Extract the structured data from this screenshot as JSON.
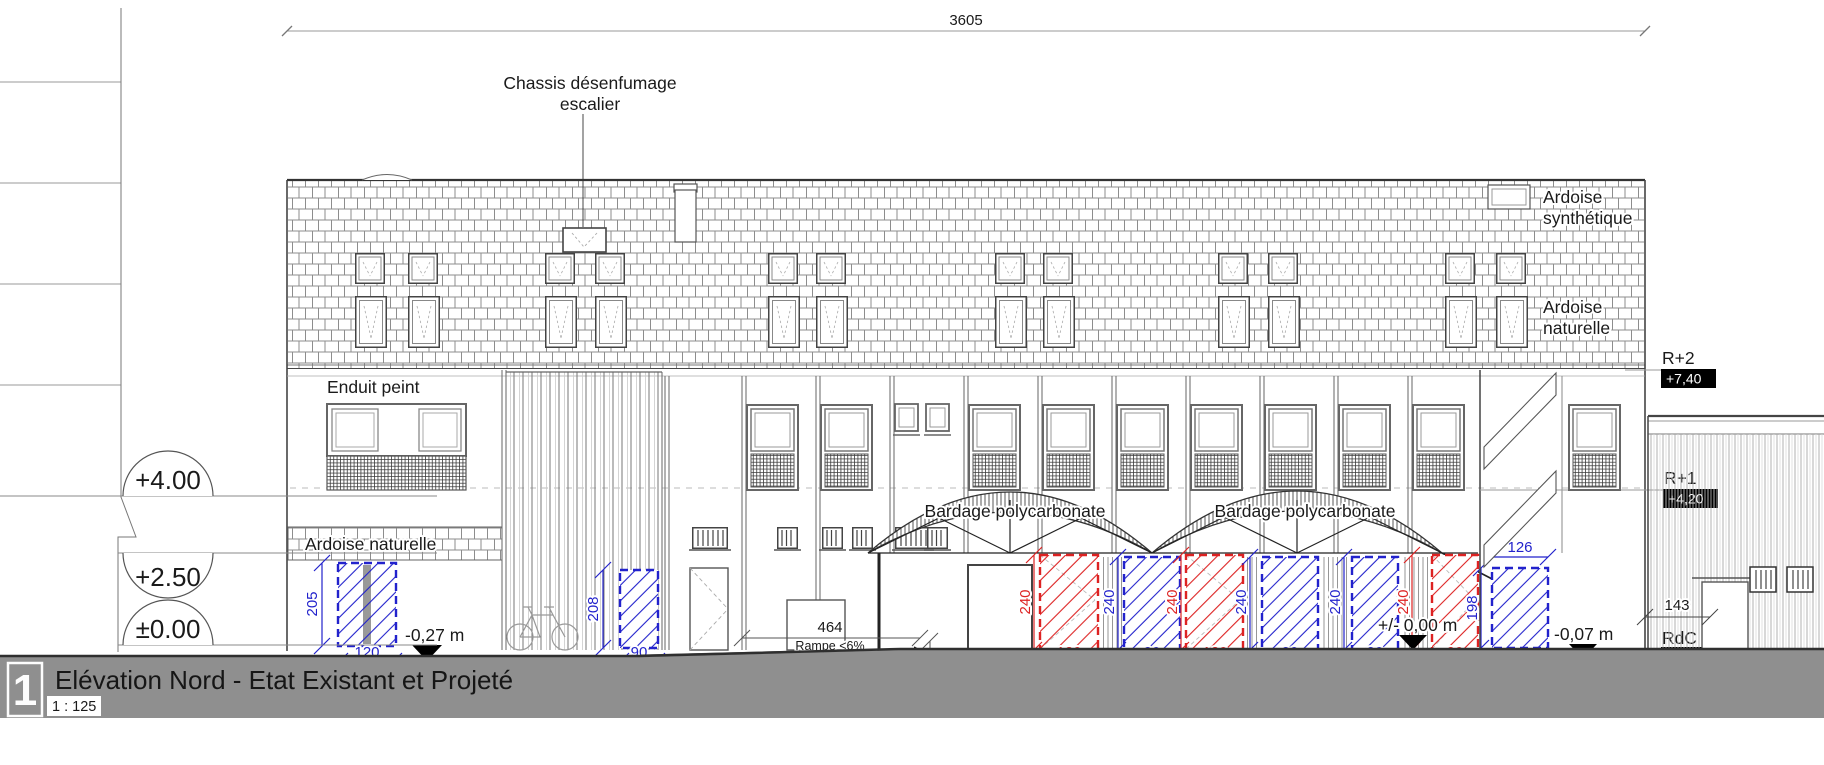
{
  "colors": {
    "projected_red": "#dd2222",
    "existing_blue": "#2222cc",
    "ground_gray": "#8f8f8f"
  },
  "title_block": {
    "sheet_number": "1",
    "title": "Elévation Nord - Etat Existant et Projeté",
    "scale": "1 : 125"
  },
  "top_dimension": "3605",
  "annotation_smoke_vent": {
    "line1": "Chassis désenfumage",
    "line2": "escalier"
  },
  "material_labels": {
    "enduit_peint": "Enduit peint",
    "ardoise_naturelle_left": "Ardoise naturelle",
    "ardoise_synthetique": {
      "line1": "Ardoise",
      "line2": "synthétique"
    },
    "ardoise_naturelle_right": {
      "line1": "Ardoise",
      "line2": "naturelle"
    },
    "bardage_1": "Bardage polycarbonate",
    "bardage_2": "Bardage polycarbonate"
  },
  "levels_left": {
    "l1": "+4.00",
    "l2": "+2.50",
    "l3": "±0.00"
  },
  "levels_right": {
    "r2": {
      "name": "R+2",
      "value": "+7,40"
    },
    "r1": {
      "name": "R+1",
      "value": "+4,20"
    },
    "rdc": {
      "name": "RdC",
      "value": "+0,00"
    }
  },
  "ground_levels": {
    "left": "-0,27 m",
    "center": "+/- 0,00 m",
    "right": "-0,07 m"
  },
  "ramp": {
    "width": "464",
    "slope": "Rampe <6%",
    "step": "27"
  },
  "neighbor_dimension": "143",
  "doors": [
    {
      "height": "205",
      "width": "120",
      "color": "blue"
    },
    {
      "height": "208",
      "width": "90",
      "color": "blue"
    },
    {
      "height": "240",
      "width": "120",
      "color": "red"
    },
    {
      "height": "240",
      "width": "90",
      "color": "blue"
    },
    {
      "height": "240",
      "width": "120",
      "color": "red"
    },
    {
      "height": "240",
      "width": "90",
      "color": "blue"
    },
    {
      "height": "240",
      "width": "90",
      "color": "blue"
    },
    {
      "height": "240",
      "width": "90",
      "color": "red"
    },
    {
      "height": "198",
      "width": "126",
      "color": "blue"
    }
  ]
}
